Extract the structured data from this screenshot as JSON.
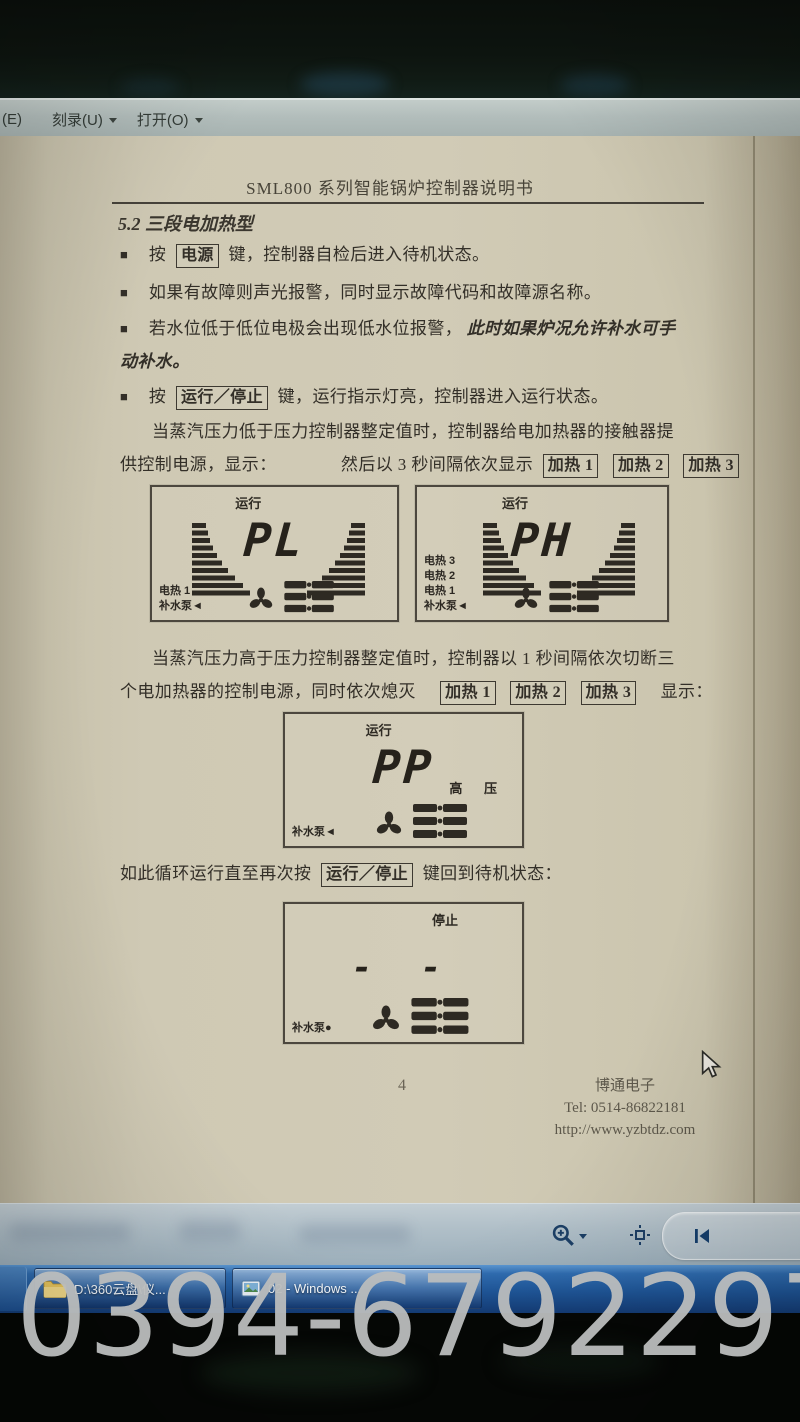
{
  "menu_bar": {
    "item_partial": "(E)",
    "items": [
      {
        "label": "刻录(U)"
      },
      {
        "label": "打开(O)"
      }
    ]
  },
  "document": {
    "header_title": "SML800 系列智能锅炉控制器说明书",
    "section_title": "5.2 三段电加热型",
    "bullet_glyph": "■",
    "bullets": {
      "b1_pre": "按",
      "b1_key": "电源",
      "b1_post": "键，控制器自检后进入待机状态。",
      "b2": "如果有故障则声光报警，同时显示故障代码和故障源名称。",
      "b3_normal": "若水位低于低位电极会出现低水位报警，",
      "b3_italic": "此时如果炉况允许补水可手",
      "b3_line2": "动补水。",
      "b4_pre": "按",
      "b4_key": "运行／停止",
      "b4_post": "键，运行指示灯亮，控制器进入运行状态。"
    },
    "para_low": {
      "line1": "当蒸汽压力低于压力控制器整定值时，控制器给电加热器的接触器提",
      "line2a": "供控制电源，显示：",
      "line2b": "然后以 3 秒间隔依次显示",
      "keys": [
        "加热 1",
        "加热 2",
        "加热 3"
      ]
    },
    "para_high": {
      "line1": "当蒸汽压力高于压力控制器整定值时，控制器以 1 秒间隔依次切断三",
      "line2a": "个电加热器的控制电源，同时依次熄灭",
      "keys": [
        "加热 1",
        "加热 2",
        "加热 3"
      ],
      "line2b": "显示："
    },
    "loop_line": {
      "pre": "如此循环运行直至再次按",
      "key": "运行／停止",
      "post": "键回到待机状态："
    },
    "panels": {
      "p1": {
        "status": "运行",
        "value": "PL",
        "labels": [
          "电热 1",
          "补水泵◄"
        ]
      },
      "p2": {
        "status": "运行",
        "value": "PH",
        "labels": [
          "电热 3",
          "电热 2",
          "电热 1",
          "补水泵◄"
        ]
      },
      "p3": {
        "status": "运行",
        "value": "PP",
        "right_label": "高 压",
        "labels": [
          "补水泵◄"
        ]
      },
      "p4": {
        "status": "停止",
        "value": "- -",
        "labels": [
          "补水泵●"
        ]
      }
    },
    "footer": {
      "page_number": "4",
      "company": "博通电子",
      "tel": "Tel: 0514-86822181",
      "url": "http://www.yzbtdz.com"
    }
  },
  "viewer_toolbar": {
    "icons": {
      "zoom": "magnifier-plus",
      "actual_size": "actual-size",
      "previous": "previous-frame",
      "slideshow": "play-slideshow"
    }
  },
  "taskbar": {
    "buttons": [
      {
        "label": "D:\\360云盘\\仪...",
        "icon": "folder"
      },
      {
        "label": "02 - Windows ...",
        "icon": "photo-viewer"
      }
    ]
  },
  "watermark": "0394-6792297",
  "colors": {
    "taskbar_blue": "#1f5698",
    "paper": "#cfc9b4",
    "menu_bar": "#b2bdbb",
    "watermark_gray": "#babdbd"
  }
}
